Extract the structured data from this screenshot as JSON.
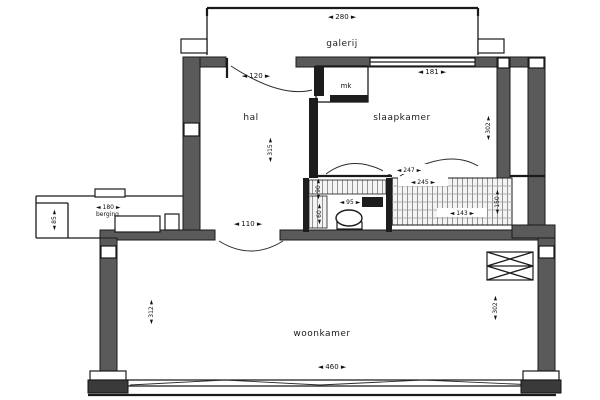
{
  "plan": {
    "title": "apartment floor plan",
    "colors": {
      "wall": "#5a5a5a",
      "line": "#1a1a1a",
      "background": "#ffffff"
    },
    "rooms": {
      "galerij": "galerij",
      "hal": "hal",
      "mk": "mk",
      "slaapkamer": "slaapkamer",
      "wc": "",
      "balkon": "",
      "berging": "berging",
      "woonkamer": "woonkamer"
    },
    "dims": {
      "galerij_width": "◄ 280 ►",
      "entry_door_width": "◄ 120 ►",
      "slaapkamer_width": "◄ 181 ►",
      "hal_height": "◄ 315 ►",
      "slaapkamer_height": "◄ 302 ►",
      "mid_upper_width": "◄ 247 ►",
      "mid_lower_width": "◄ 245 ►",
      "wc_width": "◄ 95 ►",
      "wc_height_a": "◄ 90 ►",
      "wc_height_b": "◄ 60 ►",
      "balkon_width": "◄ 143 ►",
      "balkon_height": "◄ 150 ►",
      "hal_woonkamer_door": "◄ 110 ►",
      "berging_width": "◄ 180 ►",
      "berging_height": "◄ 85 ►",
      "woonkamer_width": "◄ 460 ►",
      "woonkamer_height_left": "◄ 312 ►",
      "woonkamer_height_right": "◄ 302 ►"
    }
  }
}
